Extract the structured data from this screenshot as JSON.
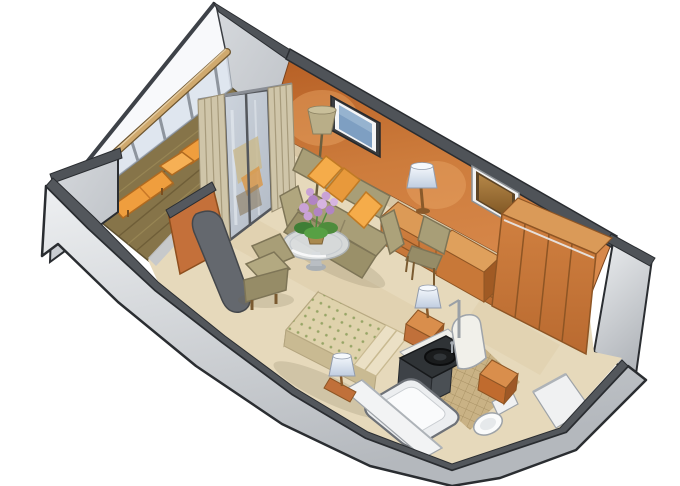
{
  "scene": {
    "kind": "isometric cutaway floor plan illustration",
    "subject": "cruise ship stateroom with private balcony",
    "background": "#ffffff"
  },
  "palette": {
    "outline": "#2a2d31",
    "wall_cap_gray": "#4f5358",
    "outer_wall_light": "#c9ccd1",
    "outer_wall_lighter": "#edeff1",
    "accent_wall_orange": "#c9742f",
    "wood_furniture": "#ce7e3e",
    "wood_dark_side": "#9e5826",
    "carpet": "#e6d9bb",
    "deck_planks": "#867449",
    "lounger_orange": "#ef9e3e",
    "sofa_olive": "#a89e77",
    "pillow_orange": "#f5ac4a",
    "bedspread": "#dfd2ac",
    "bedspread_dot_green": "#8fa05e",
    "curtain_tan": "#cfc5a9",
    "glass_blue": "#dde4ee",
    "tv_screen_blue": "#7e9fc2",
    "mirror_bronze": "#a87c3e",
    "flower_purple": "#c9a2d6",
    "leaf_green": "#3f7e35",
    "bath_tile": "#c9b285",
    "vanity_charcoal": "#2f3336",
    "fixture_white": "#fafbfc",
    "lamp_shade_blue_white": "#e8eef6"
  },
  "areas": {
    "balcony": {
      "label": "balcony",
      "items": [
        "plank-deck",
        "glass-railing-with-wood-cap-rail",
        "railing-posts",
        "balcony-divider-wall-far",
        "balcony-divider-wall-near",
        "lounge-chair-upper",
        "lounge-chair-lower",
        "sliding-glass-door",
        "curtain-left",
        "curtain-right"
      ]
    },
    "living_area": {
      "label": "living area",
      "items": [
        "sofa",
        "sofa-pillows",
        "floor-lamp",
        "glass-coffee-table",
        "flower-pot",
        "armchair",
        "wall-tv",
        "accent-wall"
      ]
    },
    "work_wardrobe_area": {
      "label": "desk and wardrobe",
      "items": [
        "dresser-drawers",
        "tv-cabinet",
        "desk-chair",
        "table-lamp",
        "wall-mirror",
        "wardrobe-closet-folding-doors"
      ]
    },
    "sleeping_area": {
      "label": "sleeping area",
      "items": [
        "double-bed-dotted-bedspread",
        "bed-pillows",
        "nightstand",
        "bedside-lamp-right",
        "bedside-lamp-left"
      ]
    },
    "bathroom": {
      "label": "bathroom",
      "items": [
        "vanity-round-sink",
        "faucet",
        "bathtub",
        "toilet",
        "tile-floor",
        "shower-pole",
        "rounded-partition"
      ]
    },
    "entry": {
      "label": "entry",
      "items": [
        "entry-cabinet",
        "corridor-walls",
        "hull-wall"
      ]
    }
  },
  "counts": {
    "lounge_chairs": 2,
    "sofa_pillows": 3,
    "bedside_lamps": 2,
    "table_lamps": 1,
    "floor_lamps": 1
  }
}
